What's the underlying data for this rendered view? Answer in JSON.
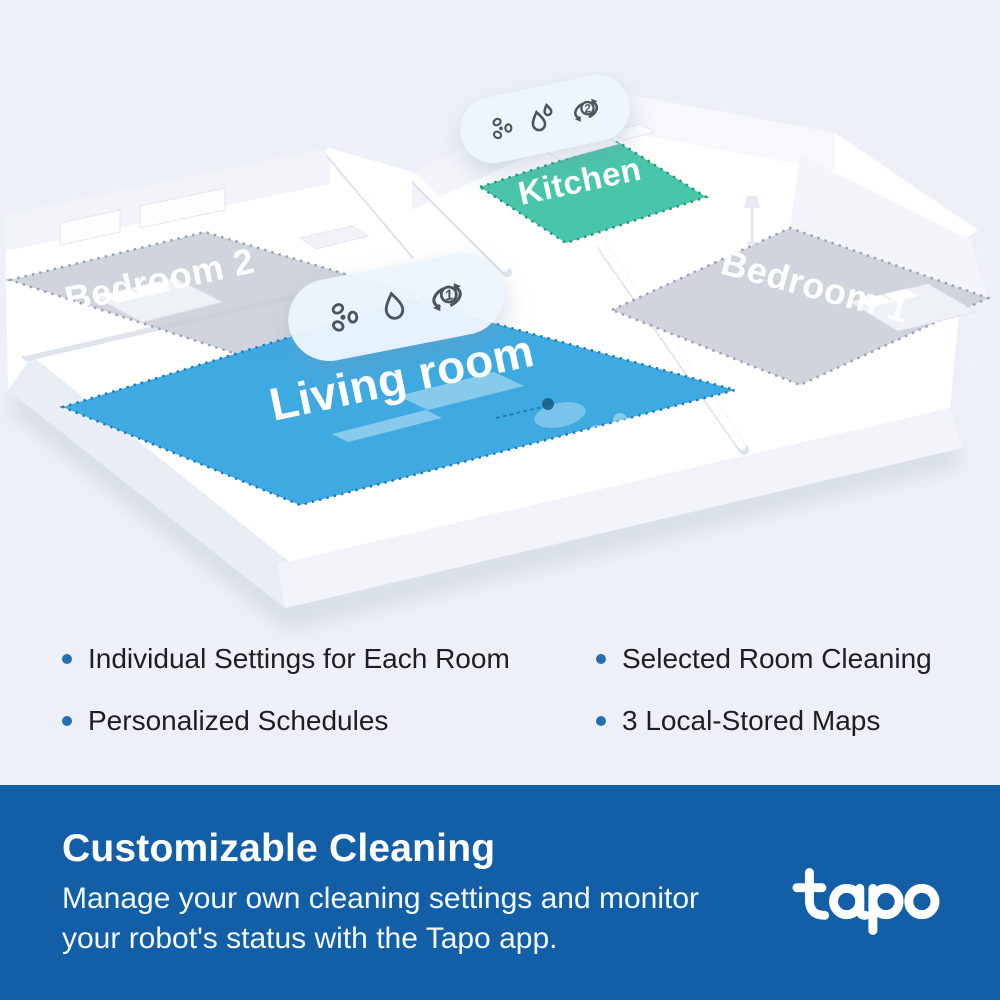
{
  "scene": {
    "rooms": [
      {
        "id": "bedroom2",
        "label": "Bedroom 2",
        "fill": "#c8cdd7",
        "border": "#9ba3b2"
      },
      {
        "id": "kitchen",
        "label": "Kitchen",
        "fill": "#3fc3a5",
        "border": "#21997e"
      },
      {
        "id": "bedroom1",
        "label": "Bedroom 1",
        "fill": "#c8cdd7",
        "border": "#9ba3b2"
      },
      {
        "id": "living",
        "label": "Living room",
        "fill": "#39a7e0",
        "border": "#1b7ec2"
      }
    ],
    "badges": [
      {
        "id": "kitchen-badge",
        "icons": [
          "fan-icon",
          "droplets-icon",
          "repeat-icon"
        ],
        "repeat_count": "2"
      },
      {
        "id": "living-badge",
        "icons": [
          "fan-icon",
          "droplet-icon",
          "repeat-icon"
        ],
        "repeat_count": "1"
      }
    ]
  },
  "features": {
    "bullet_color": "#2270b2",
    "left": [
      "Individual Settings for Each Room",
      "Personalized Schedules"
    ],
    "right": [
      "Selected Room Cleaning",
      "3 Local-Stored Maps"
    ]
  },
  "banner": {
    "background": "#125fa8",
    "title": "Customizable Cleaning",
    "description": "Manage your own cleaning settings and monitor your robot's status with the Tapo app.",
    "brand": "tapo"
  }
}
